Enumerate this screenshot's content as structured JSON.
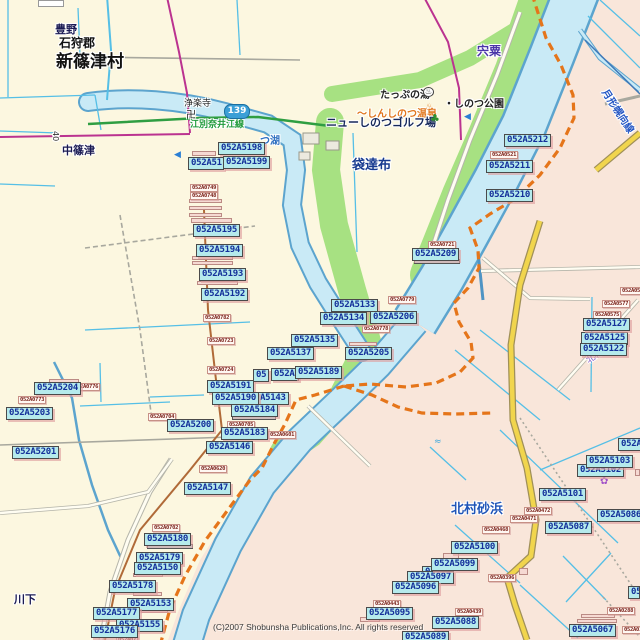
{
  "map": {
    "colors": {
      "land": "#fcf7e0",
      "adjacent_area": "#f9e6da",
      "river_fill": "#c9eaf6",
      "river_edge": "#5ca4ce",
      "park_green": "#a7e182",
      "boundary_orange": "#e5751a",
      "road_yellow": "#f1d54d",
      "road_magenta": "#bb3390",
      "road_green": "#2f9e42",
      "grid_cyan": "#55bfe6",
      "chip_fill": "#b5eaec",
      "chip_text": "#14309a",
      "chip_small_text": "#7c241c"
    }
  },
  "shield": {
    "label": "139"
  },
  "copyright": {
    "text": "(C)2007 Shobunsha Publications,Inc. All rights reserved"
  },
  "place_labels": [
    {
      "t": "豊野",
      "x": 55,
      "y": 21,
      "s": 11,
      "c": "#1a1a53",
      "b": 1
    },
    {
      "t": "石狩郡",
      "x": 59,
      "y": 34,
      "s": 12,
      "c": "#111111",
      "b": 1
    },
    {
      "t": "新篠津村",
      "x": 56,
      "y": 47,
      "s": 17,
      "c": "#111111",
      "b": 1
    },
    {
      "t": "浄楽寺",
      "x": 184,
      "y": 96,
      "s": 9,
      "c": "#222222"
    },
    {
      "t": "卍",
      "x": 186,
      "y": 106,
      "s": 10,
      "c": "#222222"
    },
    {
      "t": "江別奈井江線",
      "x": 190,
      "y": 117,
      "s": 9,
      "c": "#1f9a3a",
      "b": 1
    },
    {
      "t": "中篠津",
      "x": 62,
      "y": 142,
      "s": 11,
      "c": "#1a1a53",
      "b": 1
    },
    {
      "t": "つ湖",
      "x": 260,
      "y": 132,
      "s": 10,
      "c": "#2e6fc0",
      "b": 1
    },
    {
      "t": "袋達布",
      "x": 352,
      "y": 154,
      "s": 13,
      "c": "#173a8f",
      "b": 1
    },
    {
      "t": "宍粟",
      "x": 477,
      "y": 42,
      "s": 12,
      "c": "#4a35a8",
      "b": 1
    },
    {
      "t": "たっぷの湯",
      "x": 380,
      "y": 86,
      "s": 10,
      "c": "#222222",
      "b": 1
    },
    {
      "t": "・しのつ公園",
      "x": 444,
      "y": 95,
      "s": 10,
      "c": "#222222",
      "b": 1
    },
    {
      "t": "～しんしのつ温泉",
      "x": 357,
      "y": 105,
      "s": 10,
      "c": "#e1761d",
      "b": 1
    },
    {
      "t": "ニューしのつゴルフ場",
      "x": 326,
      "y": 114,
      "s": 11,
      "c": "#16285a",
      "b": 1
    },
    {
      "t": "北村砂浜",
      "x": 451,
      "y": 498,
      "s": 13,
      "c": "#1f55b8",
      "b": 1
    },
    {
      "t": "川下",
      "x": 14,
      "y": 591,
      "s": 11,
      "c": "#1a1a53",
      "b": 1
    },
    {
      "t": "月形幌向線",
      "x": 594,
      "y": 103,
      "s": 10,
      "c": "#2456c4",
      "b": 1,
      "r": 57
    },
    {
      "t": "北村",
      "x": 585,
      "y": 349,
      "s": 9,
      "c": "#8a5cc8",
      "r": -33
    },
    {
      "t": "40",
      "x": 51,
      "y": 131,
      "s": 8,
      "c": "#333333",
      "v": 1
    }
  ],
  "icons": [
    {
      "g": "♨",
      "x": 423,
      "y": 87,
      "s": 8,
      "c": "#222222",
      "circle": 1
    },
    {
      "g": "♨",
      "x": 425,
      "y": 103,
      "s": 10,
      "c": "#e1761d"
    },
    {
      "g": "♣",
      "x": 430,
      "y": 113,
      "s": 11,
      "c": "#2f8f2f"
    },
    {
      "g": "◀",
      "x": 174,
      "y": 151,
      "s": 9,
      "c": "#2b7fd4"
    },
    {
      "g": "◀",
      "x": 464,
      "y": 113,
      "s": 9,
      "c": "#2b7fd4"
    },
    {
      "g": "✿",
      "x": 600,
      "y": 477,
      "s": 10,
      "c": "#a050c8"
    },
    {
      "g": "≈",
      "x": 434,
      "y": 438,
      "s": 9,
      "c": "#3fa8dc"
    }
  ],
  "code_labels": [
    {
      "t": "052A5198",
      "x": 218,
      "y": 142
    },
    {
      "t": "052A51",
      "x": 188,
      "y": 157,
      "w": 36
    },
    {
      "t": "052A5199",
      "x": 223,
      "y": 156
    },
    {
      "t": "052A5195",
      "x": 193,
      "y": 224
    },
    {
      "t": "052A5194",
      "x": 196,
      "y": 244
    },
    {
      "t": "052A5193",
      "x": 199,
      "y": 268
    },
    {
      "t": "052A5192",
      "x": 201,
      "y": 288
    },
    {
      "t": "052A5133",
      "x": 331,
      "y": 299
    },
    {
      "t": "052A5134",
      "x": 320,
      "y": 312
    },
    {
      "t": "052A5206",
      "x": 370,
      "y": 311
    },
    {
      "t": "052A5135",
      "x": 291,
      "y": 334
    },
    {
      "t": "052A5137",
      "x": 267,
      "y": 347
    },
    {
      "t": "052A5205",
      "x": 345,
      "y": 347
    },
    {
      "t": "05",
      "x": 253,
      "y": 369,
      "w": 16
    },
    {
      "t": "052A",
      "x": 271,
      "y": 368,
      "w": 28
    },
    {
      "t": "052A5189",
      "x": 295,
      "y": 366
    },
    {
      "t": "052A5191",
      "x": 207,
      "y": 380
    },
    {
      "t": "A5143",
      "x": 257,
      "y": 392
    },
    {
      "t": "052A5190",
      "x": 212,
      "y": 392
    },
    {
      "t": "052A5184",
      "x": 231,
      "y": 404
    },
    {
      "t": "052A5183",
      "x": 221,
      "y": 427
    },
    {
      "t": "052A5146",
      "x": 206,
      "y": 441
    },
    {
      "t": "052A5200",
      "x": 167,
      "y": 419
    },
    {
      "t": "052A5204",
      "x": 34,
      "y": 382
    },
    {
      "t": "052A5203",
      "x": 6,
      "y": 407
    },
    {
      "t": "052A5201",
      "x": 12,
      "y": 446
    },
    {
      "t": "052A5147",
      "x": 184,
      "y": 482
    },
    {
      "t": "052A5180",
      "x": 144,
      "y": 533
    },
    {
      "t": "052A5179",
      "x": 136,
      "y": 552
    },
    {
      "t": "052A5150",
      "x": 134,
      "y": 562
    },
    {
      "t": "052A5178",
      "x": 109,
      "y": 580
    },
    {
      "t": "052A5153",
      "x": 127,
      "y": 598
    },
    {
      "t": "052A5177",
      "x": 93,
      "y": 607
    },
    {
      "t": "052A5155",
      "x": 116,
      "y": 619
    },
    {
      "t": "052A5176",
      "x": 91,
      "y": 625
    },
    {
      "t": "052A5212",
      "x": 504,
      "y": 134
    },
    {
      "t": "052A5211",
      "x": 486,
      "y": 160
    },
    {
      "t": "052A5210",
      "x": 486,
      "y": 189
    },
    {
      "t": "052A5209",
      "x": 412,
      "y": 248
    },
    {
      "t": "052A5125",
      "x": 581,
      "y": 332
    },
    {
      "t": "052A5122",
      "x": 580,
      "y": 343
    },
    {
      "t": "052A5127",
      "x": 583,
      "y": 318
    },
    {
      "t": "052A51",
      "x": 618,
      "y": 438
    },
    {
      "t": "052A5102",
      "x": 577,
      "y": 464
    },
    {
      "t": "052A5103",
      "x": 586,
      "y": 455
    },
    {
      "t": "052A5101",
      "x": 539,
      "y": 488
    },
    {
      "t": "052A5087",
      "x": 545,
      "y": 521
    },
    {
      "t": "052A5086",
      "x": 597,
      "y": 509
    },
    {
      "t": "052A5100",
      "x": 451,
      "y": 541
    },
    {
      "t": "05",
      "x": 422,
      "y": 566,
      "w": 18
    },
    {
      "t": "052A5097",
      "x": 407,
      "y": 571
    },
    {
      "t": "052A5099",
      "x": 431,
      "y": 558
    },
    {
      "t": "052A5096",
      "x": 392,
      "y": 581
    },
    {
      "t": "052A5095",
      "x": 366,
      "y": 607
    },
    {
      "t": "052A5088",
      "x": 432,
      "y": 616
    },
    {
      "t": "052A5089",
      "x": 402,
      "y": 631
    },
    {
      "t": "052A5067",
      "x": 569,
      "y": 624
    },
    {
      "t": "05",
      "x": 628,
      "y": 586,
      "w": 12
    }
  ],
  "code_labels_small": [
    {
      "t": "052A0749",
      "x": 190,
      "y": 184
    },
    {
      "t": "052A0748",
      "x": 190,
      "y": 192
    },
    {
      "t": "052A0782",
      "x": 203,
      "y": 314
    },
    {
      "t": "052A0723",
      "x": 207,
      "y": 337
    },
    {
      "t": "052A0779",
      "x": 388,
      "y": 296
    },
    {
      "t": "052A0778",
      "x": 362,
      "y": 325
    },
    {
      "t": "052A0724",
      "x": 207,
      "y": 366
    },
    {
      "t": "052A0704",
      "x": 148,
      "y": 413
    },
    {
      "t": "052A0705",
      "x": 227,
      "y": 421
    },
    {
      "t": "052A0601",
      "x": 268,
      "y": 431
    },
    {
      "t": "052A0620",
      "x": 199,
      "y": 465
    },
    {
      "t": "052A0702",
      "x": 152,
      "y": 524
    },
    {
      "t": "052A0773",
      "x": 18,
      "y": 396
    },
    {
      "t": "052A0776",
      "x": 72,
      "y": 383
    },
    {
      "t": "052A0721",
      "x": 428,
      "y": 241
    },
    {
      "t": "052A0521",
      "x": 490,
      "y": 151
    },
    {
      "t": "052A0577",
      "x": 602,
      "y": 300
    },
    {
      "t": "052A0575",
      "x": 593,
      "y": 311
    },
    {
      "t": "052A05",
      "x": 620,
      "y": 287,
      "w": 21
    },
    {
      "t": "052A0472",
      "x": 524,
      "y": 507
    },
    {
      "t": "052A0471",
      "x": 510,
      "y": 515
    },
    {
      "t": "052A0468",
      "x": 482,
      "y": 526
    },
    {
      "t": "052A0443",
      "x": 373,
      "y": 600
    },
    {
      "t": "052A0439",
      "x": 455,
      "y": 608
    },
    {
      "t": "052A0396",
      "x": 488,
      "y": 574
    },
    {
      "t": "052A0288",
      "x": 607,
      "y": 607
    },
    {
      "t": "052A012",
      "x": 622,
      "y": 626
    },
    {
      "t": "052A07",
      "x": 116,
      "y": 636
    }
  ],
  "slivers": [
    {
      "x": 38,
      "y": 0,
      "w": 26,
      "h": 7,
      "k": "w"
    },
    {
      "x": 192,
      "y": 151,
      "w": 24,
      "h": 5,
      "k": "p"
    },
    {
      "x": 189,
      "y": 199,
      "w": 33,
      "h": 4,
      "k": "p"
    },
    {
      "x": 189,
      "y": 206,
      "w": 33,
      "h": 4,
      "k": "p"
    },
    {
      "x": 189,
      "y": 213,
      "w": 33,
      "h": 4,
      "k": "p"
    },
    {
      "x": 191,
      "y": 218,
      "w": 41,
      "h": 5,
      "k": "p"
    },
    {
      "x": 192,
      "y": 256,
      "w": 41,
      "h": 4,
      "k": "p"
    },
    {
      "x": 192,
      "y": 261,
      "w": 41,
      "h": 4,
      "k": "p"
    },
    {
      "x": 197,
      "y": 281,
      "w": 41,
      "h": 4,
      "k": "p"
    },
    {
      "x": 349,
      "y": 342,
      "w": 28,
      "h": 4,
      "k": "p"
    },
    {
      "x": 414,
      "y": 259,
      "w": 46,
      "h": 5,
      "k": "c"
    },
    {
      "x": 232,
      "y": 415,
      "w": 44,
      "h": 5,
      "k": "c"
    },
    {
      "x": 147,
      "y": 544,
      "w": 46,
      "h": 5,
      "k": "c"
    },
    {
      "x": 133,
      "y": 573,
      "w": 30,
      "h": 4,
      "k": "p"
    },
    {
      "x": 133,
      "y": 592,
      "w": 29,
      "h": 4,
      "k": "p"
    },
    {
      "x": 141,
      "y": 609,
      "w": 27,
      "h": 4,
      "k": "p"
    },
    {
      "x": 49,
      "y": 379,
      "w": 30,
      "h": 4,
      "k": "p"
    },
    {
      "x": 443,
      "y": 553,
      "w": 16,
      "h": 6,
      "k": "p"
    },
    {
      "x": 360,
      "y": 617,
      "w": 20,
      "h": 5,
      "k": "p"
    },
    {
      "x": 519,
      "y": 568,
      "w": 9,
      "h": 7,
      "k": "p"
    },
    {
      "x": 635,
      "y": 469,
      "w": 5,
      "h": 7,
      "k": "p"
    },
    {
      "x": 577,
      "y": 619,
      "w": 40,
      "h": 4,
      "k": "p"
    },
    {
      "x": 581,
      "y": 614,
      "w": 34,
      "h": 4,
      "k": "p"
    }
  ]
}
